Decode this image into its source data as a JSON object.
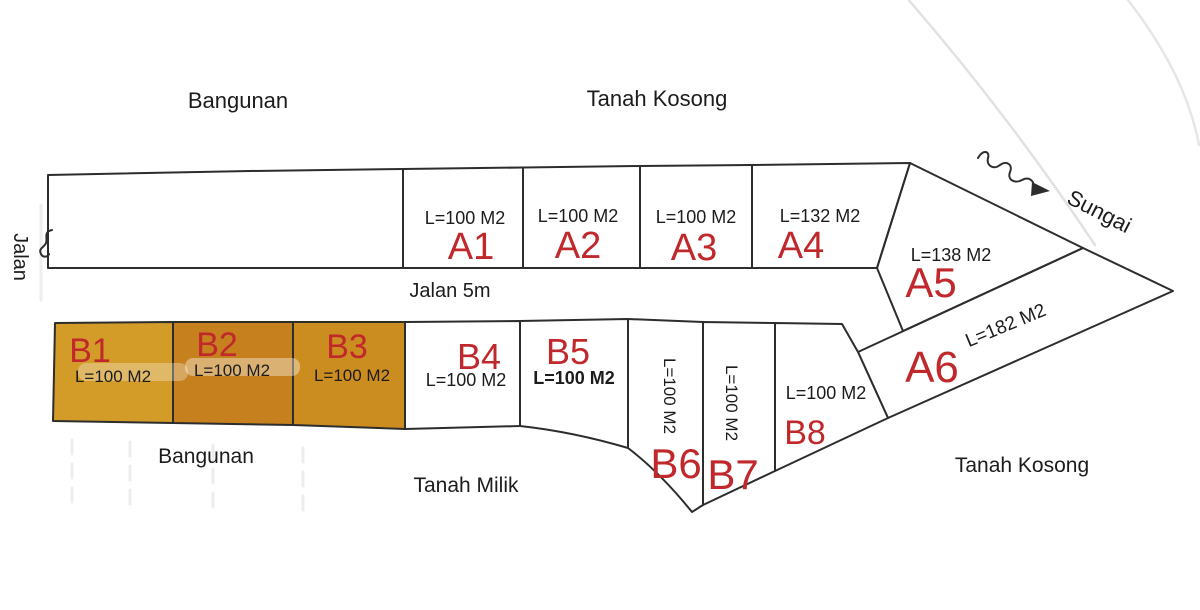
{
  "areas": {
    "top_left": "Bangunan",
    "top_center": "Tanah Kosong",
    "left_road": "Jalan",
    "center_road": "Jalan 5m",
    "river": "Sungai",
    "bottom_left": "Bangunan",
    "bottom_center": "Tanah Milik",
    "bottom_right": "Tanah Kosong"
  },
  "plots": {
    "a_row": [
      {
        "id": "A1",
        "area": "L=100 M2"
      },
      {
        "id": "A2",
        "area": "L=100 M2"
      },
      {
        "id": "A3",
        "area": "L=100 M2"
      },
      {
        "id": "A4",
        "area": "L=132 M2"
      },
      {
        "id": "A5",
        "area": "L=138 M2"
      },
      {
        "id": "A6",
        "area": "L=182 M2"
      }
    ],
    "b_row": [
      {
        "id": "B1",
        "area": "L=100 M2"
      },
      {
        "id": "B2",
        "area": "L=100 M2"
      },
      {
        "id": "B3",
        "area": "L=100 M2"
      },
      {
        "id": "B4",
        "area": "L=100 M2"
      },
      {
        "id": "B5",
        "area": "L=100 M2"
      },
      {
        "id": "B6",
        "area": "L=100 M2"
      },
      {
        "id": "B7",
        "area": "L=100 M2"
      },
      {
        "id": "B8",
        "area": "L=100 M2"
      }
    ]
  },
  "colors": {
    "line": "#2d2d2d",
    "label_red": "#c0282c",
    "text_black": "#1c1c1c",
    "b1_fill": "#d39b27",
    "b2_fill": "#c6811e",
    "b3_fill": "#cc8d20"
  }
}
